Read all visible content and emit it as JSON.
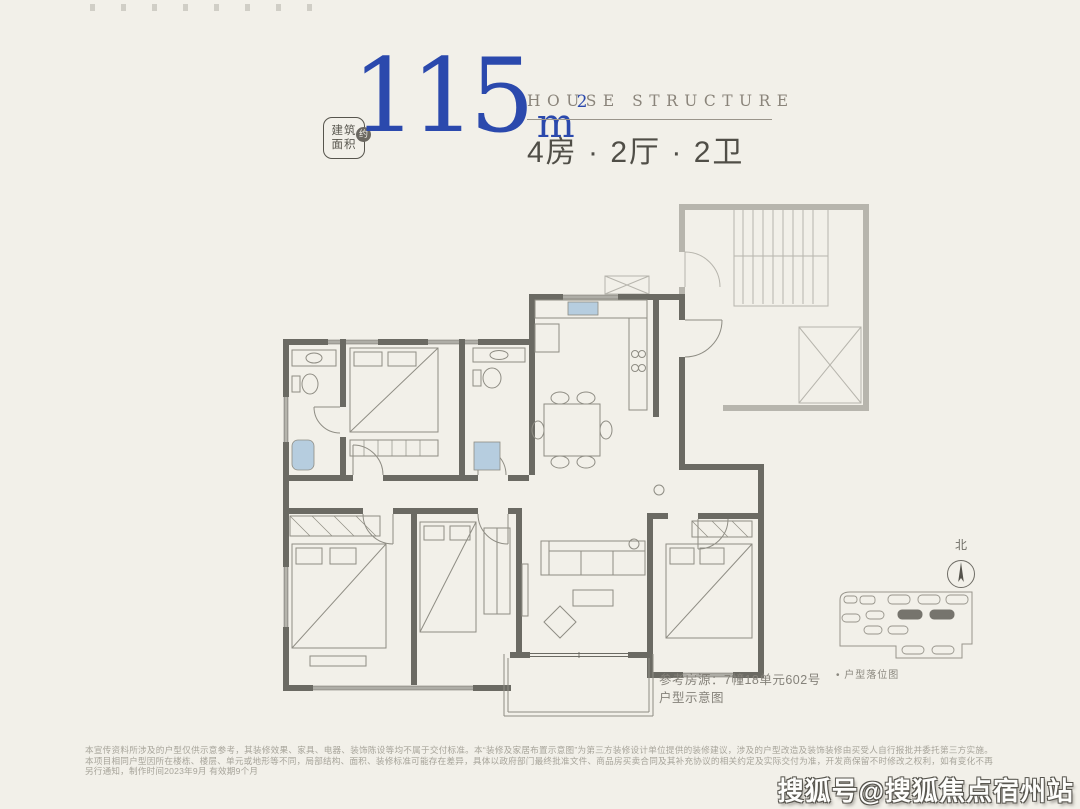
{
  "page": {
    "bg": "#f2f0e9"
  },
  "header": {
    "area_label": {
      "line1": "建筑",
      "line2": "面积",
      "badge": "约"
    },
    "area_value": "115",
    "area_unit": "m",
    "area_unit_exp": "2",
    "title_en": "HOUSE STRUCTURE",
    "title_cn": "4房 · 2厅 · 2卫"
  },
  "floorplan": {
    "north_label": "北",
    "reference_line1": "参考房源：7幢18单元602号",
    "reference_line2": "户型示意图",
    "location_label": "• 户型落位图"
  },
  "footer": {
    "disclaimer": "本宣传资料所涉及的户型仅供示意参考，其装修效果、家具、电器、装饰陈设等均不属于交付标准。本“装修及家居布置示意图”为第三方装修设计单位提供的装修建议，涉及的户型改造及装饰装修由买受人自行报批并委托第三方实施。本项目相同户型因所在楼栋、楼层、单元或地形等不同，局部结构、面积、装修标准可能存在差异，具体以政府部门最终批准文件、商品房买卖合同及其补充协议的相关约定及实际交付为准，开发商保留不时修改之权利，如有变化不再另行通知，制作时间2023年9月 有效期9个月"
  },
  "watermark": "搜狐号@搜狐焦点宿州站",
  "colors": {
    "accent_blue": "#2b49ad",
    "wall_dark": "#6b6a63",
    "wall_light": "#b7b5ad",
    "line": "#8f8d84",
    "blue_fill": "#b6cddf"
  }
}
